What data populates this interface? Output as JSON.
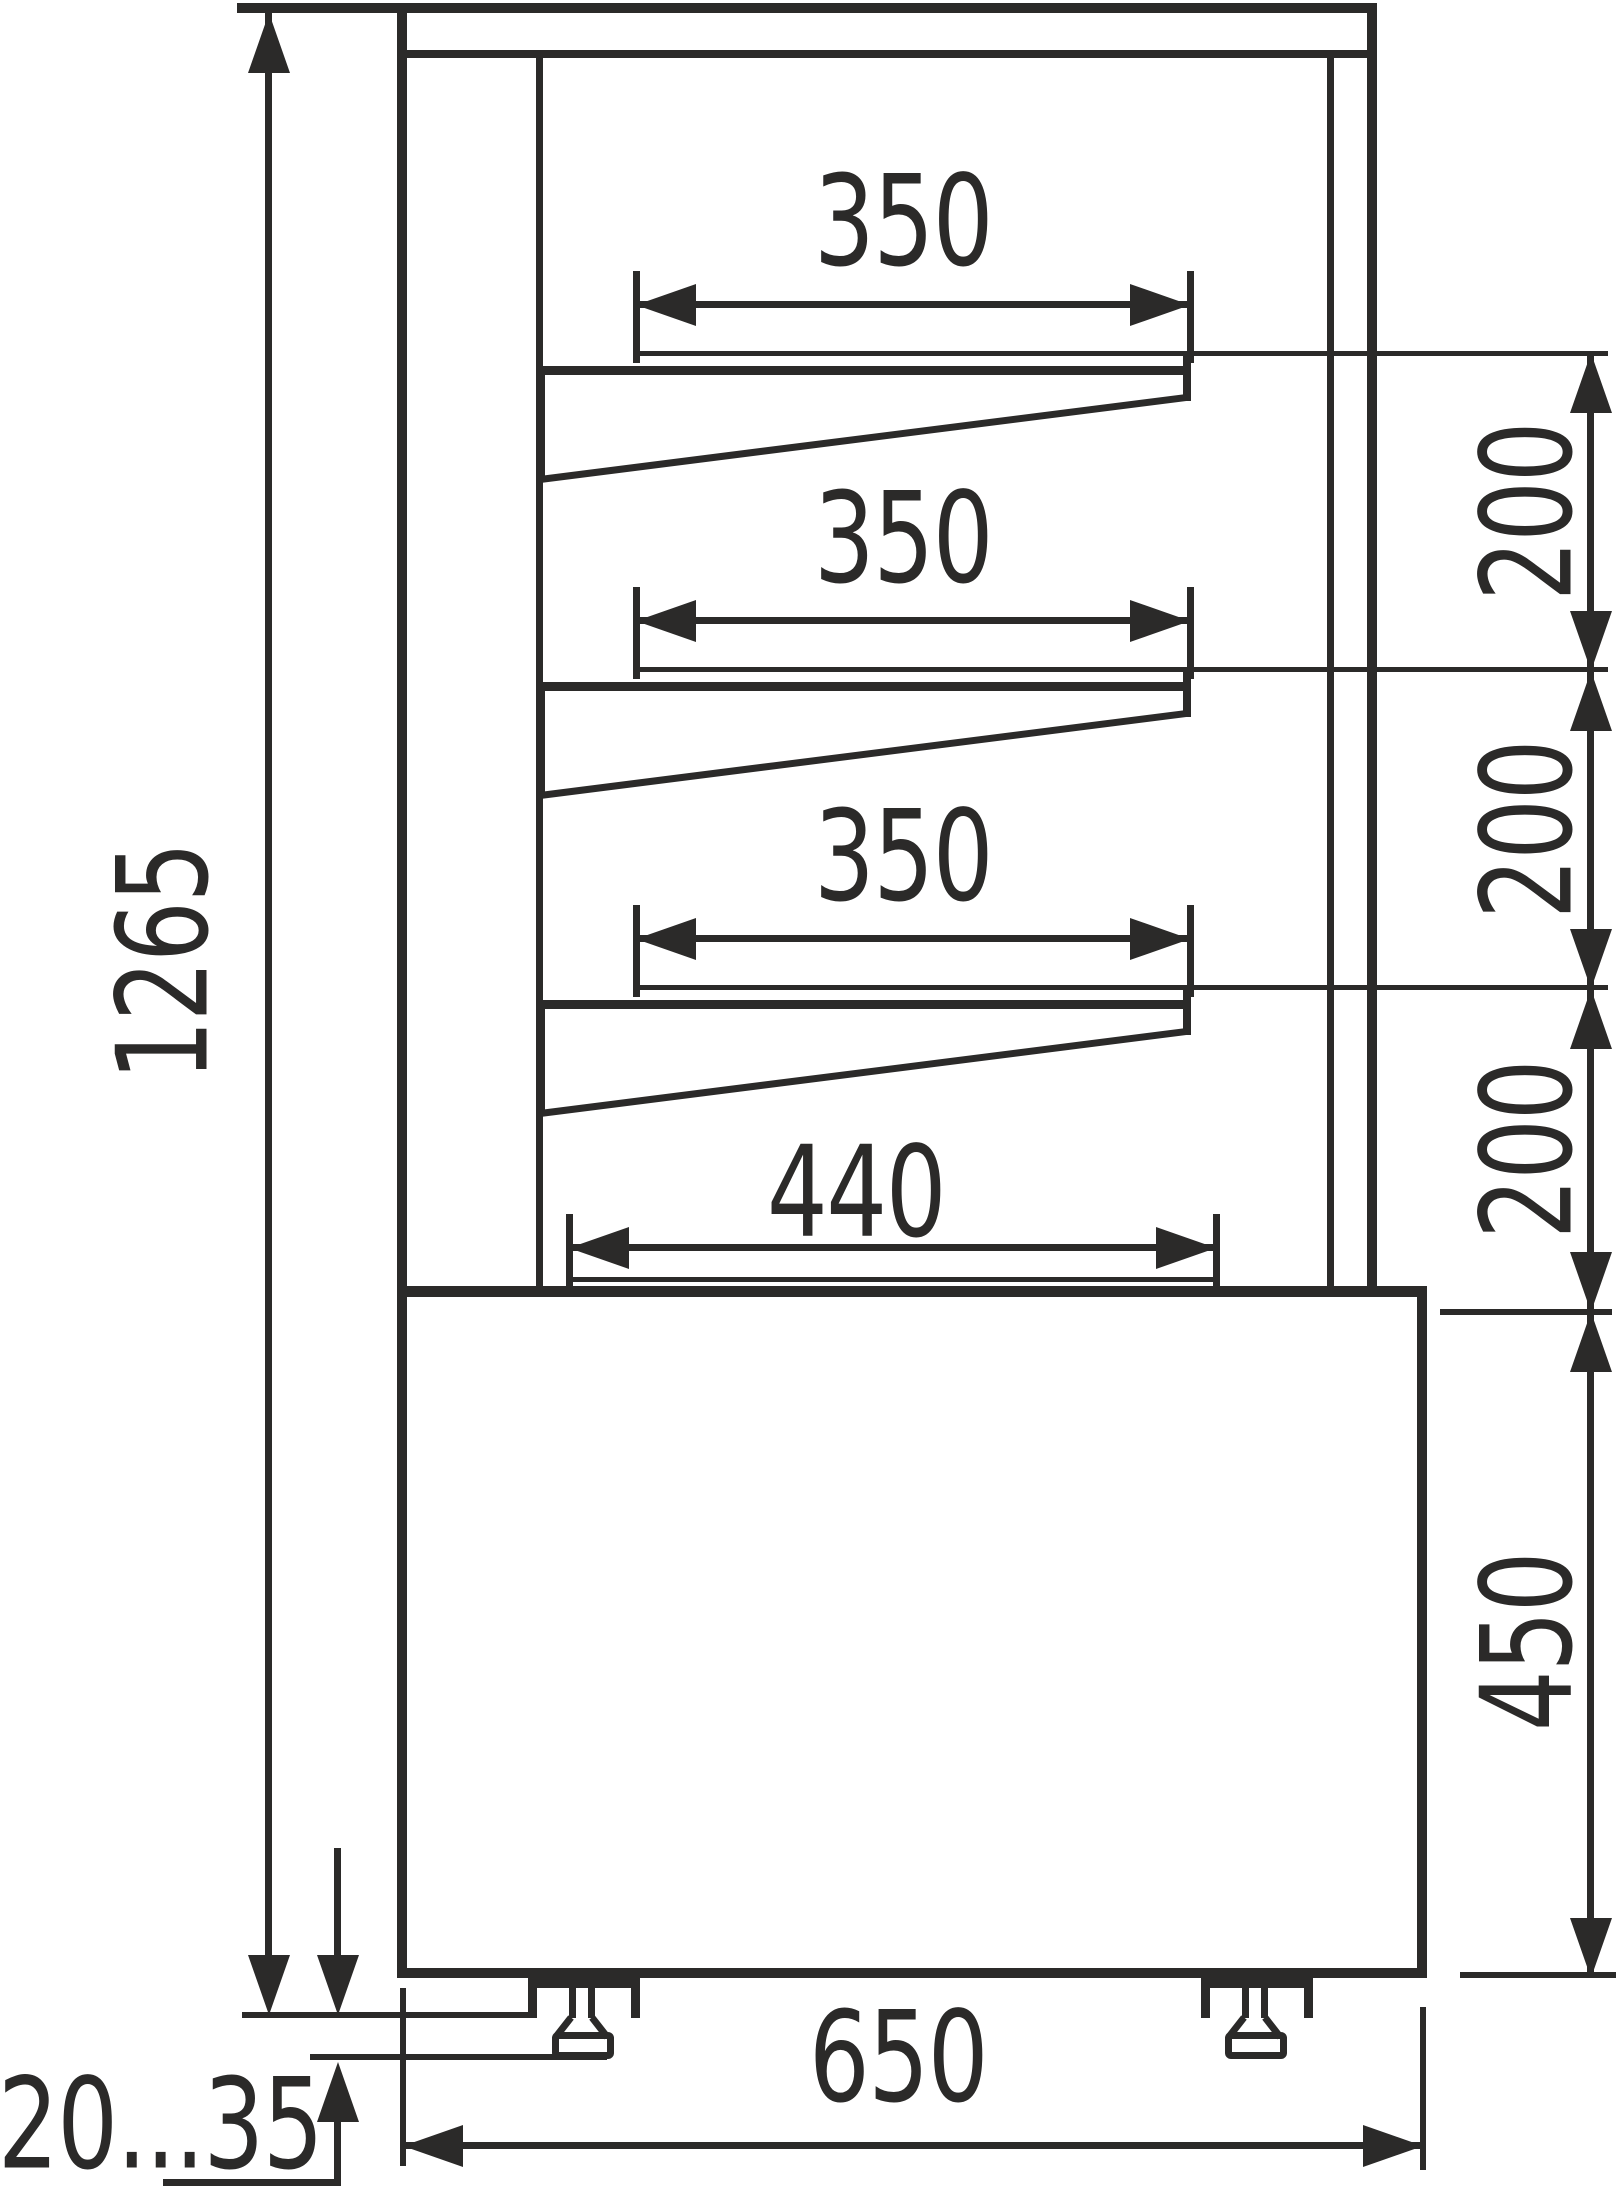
{
  "drawing": {
    "kind": "technical-dimension-drawing-side-view",
    "line_color": "#2b2a29",
    "background_color": "#ffffff"
  },
  "dims": {
    "shelf_widths": [
      "350",
      "350",
      "350"
    ],
    "deck_width": "440",
    "shelf_gaps": [
      "200",
      "200",
      "200"
    ],
    "base_height": "450",
    "overall_height": "1265",
    "base_width": "650",
    "feet_adjust": "20...35"
  }
}
